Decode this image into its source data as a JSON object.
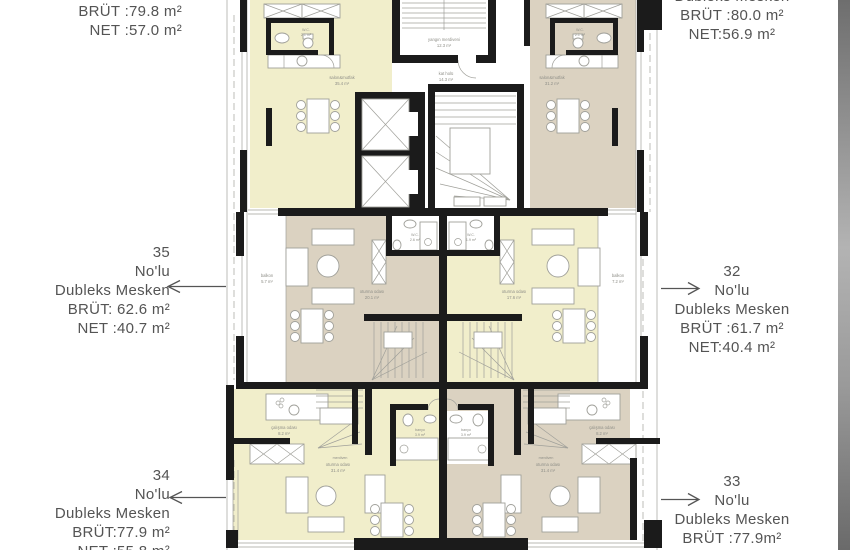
{
  "colors": {
    "floor_yellow": "#f1eecb",
    "floor_tan": "#dbd2c1",
    "wall": "#1b1b1b",
    "line": "#a0a09a",
    "label": "#8f8f88",
    "text": "#545454"
  },
  "annotations": {
    "top_left": {
      "brut": "BRÜT :79.8 m²",
      "net": "NET :57.0 m²"
    },
    "top_right": {
      "title": "Dubleks Mesken",
      "brut": "BRÜT :80.0 m²",
      "net": "NET:56.9 m²"
    },
    "mid_left": {
      "number": "35",
      "nolu": "No'lu",
      "type": "Dubleks Mesken",
      "brut": "BRÜT: 62.6 m²",
      "net": "NET :40.7 m²"
    },
    "mid_right": {
      "number": "32",
      "nolu": "No'lu",
      "type": "Dubleks Mesken",
      "brut": "BRÜT :61.7 m²",
      "net": "NET:40.4 m²"
    },
    "bottom_left": {
      "number": "34",
      "nolu": "No'lu",
      "type": "Dubleks Mesken",
      "brut": "BRÜT:77.9 m²",
      "net": "NET :55.8 m²"
    },
    "bottom_right": {
      "number": "33",
      "nolu": "No'lu",
      "type": "Dubleks Mesken",
      "brut": "BRÜT :77.9m²",
      "net": "NET:55.8 m²"
    }
  },
  "plan": {
    "labels": {
      "wc_tl": [
        "W.C.",
        "2.1 m²"
      ],
      "salon_tl": [
        "salon&mutfak",
        "35.4 m²"
      ],
      "fire": [
        "yangın merdiveni",
        "12.3 m²"
      ],
      "hall": [
        "kat holü",
        "14.3 m²"
      ],
      "wc_tr": [
        "W.C.",
        "2.1 m²"
      ],
      "salon_tr": [
        "salon&mutfak",
        "31.2 m²"
      ],
      "balkon_ml": [
        "balkon",
        "5.7 m²"
      ],
      "wc_ml": [
        "W.C.",
        "2.6 m²"
      ],
      "living_ml": [
        "oturma odası",
        "20.1 m²"
      ],
      "wc_mr": [
        "W.C.",
        "1.9 m²"
      ],
      "living_mr": [
        "oturma odası",
        "17.6 m²"
      ],
      "balkon_mr": [
        "balkon",
        "7.2 m²"
      ],
      "study_bl": [
        "çalışma odası",
        "8.2 m²"
      ],
      "stair_bl": [
        "merdiven"
      ],
      "bath_bl": [
        "banyo",
        "3.9 m²"
      ],
      "living_bl": [
        "oturma odası",
        "31.4 m²"
      ],
      "bath_br": [
        "banyo",
        "3.9 m²"
      ],
      "living_br": [
        "oturma odası",
        "31.4 m²"
      ],
      "study_br": [
        "çalışma odası",
        "8.2 m²"
      ],
      "stair_br": [
        "merdiven"
      ]
    }
  }
}
